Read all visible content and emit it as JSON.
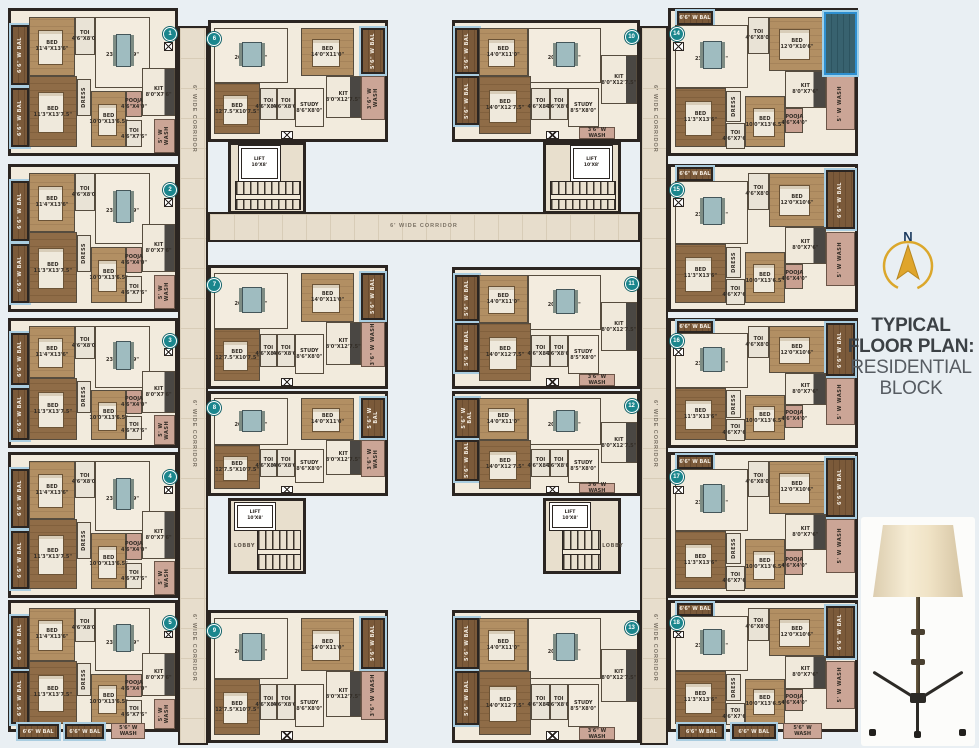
{
  "title": {
    "line1": "TYPICAL FLOOR PLAN:",
    "line2": "RESIDENTIAL BLOCK"
  },
  "compass": {
    "label": "N"
  },
  "colors": {
    "wall": "#2b2521",
    "corridor_tile": "#e7ddcc",
    "badge_teal": "#1b868d",
    "gold": "#dba72b",
    "navy": "#1c3a5e",
    "highlight_blue": "#2e8fd0",
    "title_dark": "#3c4145",
    "title_light": "#575c62",
    "background": "#e9eff3"
  },
  "plan": {
    "corridor_label": "6' WIDE CORRIDOR",
    "lift_label": {
      "name": "LIFT",
      "dims": "10'X8'"
    },
    "lobby_label": "LOBBY",
    "highlight": {
      "rect": {
        "x": 83,
        "y": 1,
        "w": 18,
        "h": 44
      }
    },
    "bottom_strips": [
      {
        "n": "6'6\" W BAL",
        "x": 4,
        "y": 96,
        "w": 25,
        "h": 12,
        "c": "bal"
      },
      {
        "n": "6'6\" W BAL",
        "x": 33,
        "y": 96,
        "w": 24,
        "h": 12,
        "c": "bal"
      },
      {
        "n": "5'6\" W WASH",
        "x": 61,
        "y": 95,
        "w": 21,
        "h": 13,
        "c": "wash"
      }
    ],
    "unit_types": {
      "corner-l": {
        "badge": {
          "x": 97,
          "y": 16
        },
        "rooms": [
          {
            "n": "6'6\" W BAL",
            "x": 0,
            "y": 10,
            "w": 11,
            "h": 42,
            "c": "bal",
            "v": 1
          },
          {
            "n": "6'6\" W BAL",
            "x": 0,
            "y": 54,
            "w": 11,
            "h": 42,
            "c": "bal",
            "v": 1
          },
          {
            "n": "BED",
            "d": "11'4\"X13'6\"",
            "x": 11,
            "y": 4,
            "w": 28,
            "h": 42,
            "c": "wood"
          },
          {
            "n": "TOI",
            "d": "4'6\"X8'0\"",
            "x": 39,
            "y": 4,
            "w": 12,
            "h": 27,
            "c": "tile"
          },
          {
            "n": "LIVDIN",
            "d": "23'3\"X10'9\"",
            "x": 51,
            "y": 4,
            "w": 34,
            "h": 50,
            "c": "cream",
            "furn": "dine"
          },
          {
            "n": "KIT",
            "d": "8'0\"X7'6\"",
            "x": 80,
            "y": 40,
            "w": 20,
            "h": 34,
            "c": "kit"
          },
          {
            "n": "BED",
            "d": "11'3\"X13'7.5\"",
            "x": 11,
            "y": 46,
            "w": 29,
            "h": 50,
            "c": "wood2"
          },
          {
            "n": "DRESS",
            "x": 40,
            "y": 48,
            "w": 9,
            "h": 26,
            "c": "tile",
            "v": 1
          },
          {
            "n": "BED",
            "d": "10'0\"X13'6.5\"",
            "x": 49,
            "y": 56,
            "w": 21,
            "h": 40,
            "c": "wood"
          },
          {
            "n": "POOJA",
            "d": "4'6\"X4'0\"",
            "x": 70,
            "y": 56,
            "w": 10,
            "h": 19,
            "c": "pink"
          },
          {
            "n": "TOI",
            "d": "4'6\"X7'6\"",
            "x": 70,
            "y": 77,
            "w": 10,
            "h": 19,
            "c": "tile"
          },
          {
            "n": "5' W WASH",
            "x": 87,
            "y": 76,
            "w": 13,
            "h": 24,
            "c": "wash",
            "v": 1
          },
          {
            "x": 93,
            "y": 22,
            "w": 6,
            "h": 6,
            "c": "door"
          }
        ]
      },
      "corner-r": {
        "badge": {
          "x": 3,
          "y": 16
        },
        "rooms": [
          {
            "n": "6'6\" W BAL",
            "x": 3,
            "y": 0,
            "w": 20,
            "h": 10,
            "c": "bal"
          },
          {
            "n": "LIVDIN",
            "d": "23'3\"X10'9\"",
            "x": 2,
            "y": 10,
            "w": 40,
            "h": 44,
            "c": "cream",
            "furn": "dine"
          },
          {
            "n": "TOI",
            "d": "4'6\"X8'0\"",
            "x": 42,
            "y": 4,
            "w": 11,
            "h": 26,
            "c": "tile"
          },
          {
            "n": "BED",
            "d": "12'0\"X10'6\"",
            "x": 53,
            "y": 4,
            "w": 31,
            "h": 38,
            "c": "wood"
          },
          {
            "n": "6'6\" W BAL",
            "x": 84,
            "y": 2,
            "w": 16,
            "h": 42,
            "c": "bal",
            "v": 1
          },
          {
            "n": "KIT",
            "d": "8'0\"X7'6\"",
            "x": 62,
            "y": 42,
            "w": 22,
            "h": 26,
            "c": "kit"
          },
          {
            "n": "5' W WASH",
            "x": 84,
            "y": 46,
            "w": 16,
            "h": 38,
            "c": "wash",
            "v": 1
          },
          {
            "n": "BED",
            "d": "11'3\"X13'6\"",
            "x": 2,
            "y": 54,
            "w": 28,
            "h": 42,
            "c": "wood2"
          },
          {
            "n": "DRESS",
            "x": 30,
            "y": 56,
            "w": 8,
            "h": 22,
            "c": "tile",
            "v": 1
          },
          {
            "n": "TOI",
            "d": "4'6\"X7'6\"",
            "x": 30,
            "y": 79,
            "w": 10,
            "h": 18,
            "c": "tile"
          },
          {
            "n": "BED",
            "d": "10'0\"X13'6.5\"",
            "x": 40,
            "y": 60,
            "w": 22,
            "h": 36,
            "c": "wood"
          },
          {
            "n": "POOJA",
            "d": "4'6\"X4'0\"",
            "x": 62,
            "y": 68,
            "w": 10,
            "h": 18,
            "c": "pink"
          },
          {
            "x": 1,
            "y": 22,
            "w": 6,
            "h": 6,
            "c": "door"
          }
        ]
      },
      "mid-l": {
        "badge": {
          "x": 2,
          "y": 14
        },
        "rooms": [
          {
            "n": "LIVDIN",
            "d": "20'5\"X10'9\"",
            "x": 2,
            "y": 4,
            "w": 42,
            "h": 48,
            "c": "cream",
            "furn": "dine"
          },
          {
            "n": "BED",
            "d": "14'0\"X11'0\"",
            "x": 52,
            "y": 4,
            "w": 30,
            "h": 42,
            "c": "wood"
          },
          {
            "n": "5'6\" W BAL",
            "x": 86,
            "y": 4,
            "w": 14,
            "h": 40,
            "c": "bal",
            "v": 1
          },
          {
            "n": "KIT",
            "d": "8'0\"X12'7.5\"",
            "x": 66,
            "y": 46,
            "w": 20,
            "h": 36,
            "c": "kit"
          },
          {
            "n": "3'6\" W WASH",
            "x": 86,
            "y": 46,
            "w": 14,
            "h": 38,
            "c": "wash",
            "v": 1
          },
          {
            "n": "BED",
            "d": "12'7.5\"X10'7.5\"",
            "x": 2,
            "y": 52,
            "w": 26,
            "h": 44,
            "c": "wood2"
          },
          {
            "n": "TOI",
            "d": "4'6\"X8'0\"",
            "x": 28,
            "y": 56,
            "w": 10,
            "h": 28,
            "c": "tile"
          },
          {
            "n": "TOI",
            "d": "4'6\"X8'0\"",
            "x": 38,
            "y": 56,
            "w": 10,
            "h": 28,
            "c": "tile"
          },
          {
            "n": "STUDY",
            "d": "8'6\"X8'0\"",
            "x": 48,
            "y": 56,
            "w": 17,
            "h": 34,
            "c": "cream"
          },
          {
            "x": 40,
            "y": 93,
            "w": 7,
            "h": 7,
            "c": "door"
          }
        ]
      },
      "mid-r": {
        "badge": {
          "x": 97,
          "y": 12
        },
        "rooms": [
          {
            "n": "5'6\" W BAL",
            "x": 0,
            "y": 4,
            "w": 13,
            "h": 40,
            "c": "bal",
            "v": 1
          },
          {
            "n": "5'6\" W BAL",
            "x": 0,
            "y": 46,
            "w": 13,
            "h": 42,
            "c": "bal",
            "v": 1
          },
          {
            "n": "BED",
            "d": "14'0\"X11'0\"",
            "x": 13,
            "y": 4,
            "w": 27,
            "h": 42,
            "c": "wood"
          },
          {
            "n": "LIVDIN",
            "d": "20'5\"X10'9\"",
            "x": 40,
            "y": 4,
            "w": 40,
            "h": 48,
            "c": "cream",
            "furn": "dine"
          },
          {
            "n": "KIT",
            "d": "8'0\"X12'7.5\"",
            "x": 80,
            "y": 28,
            "w": 20,
            "h": 42,
            "c": "kit"
          },
          {
            "n": "BED",
            "d": "14'0\"X12'7.5\"",
            "x": 13,
            "y": 46,
            "w": 29,
            "h": 50,
            "c": "wood2"
          },
          {
            "n": "TOI",
            "d": "4'6\"X8'0\"",
            "x": 42,
            "y": 56,
            "w": 10,
            "h": 28,
            "c": "tile"
          },
          {
            "n": "TOI",
            "d": "4'6\"X8'0\"",
            "x": 52,
            "y": 56,
            "w": 10,
            "h": 28,
            "c": "tile"
          },
          {
            "n": "STUDY",
            "d": "8'5\"X8'0\"",
            "x": 62,
            "y": 56,
            "w": 17,
            "h": 34,
            "c": "cream"
          },
          {
            "n": "3'6\" W WASH",
            "x": 68,
            "y": 90,
            "w": 20,
            "h": 10,
            "c": "wash"
          },
          {
            "x": 50,
            "y": 93,
            "w": 7,
            "h": 7,
            "c": "door"
          }
        ]
      }
    },
    "units": [
      {
        "badge": "1",
        "type": "corner-l",
        "x": 8,
        "y": 8,
        "w": 170,
        "h": 148
      },
      {
        "badge": "2",
        "type": "corner-l",
        "x": 8,
        "y": 164,
        "w": 170,
        "h": 148
      },
      {
        "badge": "3",
        "type": "corner-l",
        "x": 8,
        "y": 318,
        "w": 170,
        "h": 130
      },
      {
        "badge": "4",
        "type": "corner-l",
        "x": 8,
        "y": 452,
        "w": 170,
        "h": 146
      },
      {
        "badge": "5",
        "type": "corner-l",
        "x": 8,
        "y": 600,
        "w": 170,
        "h": 132,
        "bb": true
      },
      {
        "badge": "6",
        "type": "mid-l",
        "x": 208,
        "y": 20,
        "w": 180,
        "h": 122
      },
      {
        "badge": "7",
        "type": "mid-l",
        "x": 208,
        "y": 265,
        "w": 180,
        "h": 124
      },
      {
        "badge": "8",
        "type": "mid-l",
        "x": 208,
        "y": 391,
        "w": 180,
        "h": 105
      },
      {
        "badge": "9",
        "type": "mid-l",
        "x": 208,
        "y": 610,
        "w": 180,
        "h": 133
      },
      {
        "badge": "10",
        "type": "mid-r",
        "x": 452,
        "y": 20,
        "w": 188,
        "h": 122
      },
      {
        "badge": "11",
        "type": "mid-r",
        "x": 452,
        "y": 267,
        "w": 188,
        "h": 122
      },
      {
        "badge": "12",
        "type": "mid-r",
        "x": 452,
        "y": 391,
        "w": 188,
        "h": 105
      },
      {
        "badge": "13",
        "type": "mid-r",
        "x": 452,
        "y": 610,
        "w": 188,
        "h": 133
      },
      {
        "badge": "14",
        "type": "corner-r",
        "x": 668,
        "y": 8,
        "w": 190,
        "h": 148,
        "hl": true
      },
      {
        "badge": "15",
        "type": "corner-r",
        "x": 668,
        "y": 164,
        "w": 190,
        "h": 148
      },
      {
        "badge": "16",
        "type": "corner-r",
        "x": 668,
        "y": 318,
        "w": 190,
        "h": 130
      },
      {
        "badge": "17",
        "type": "corner-r",
        "x": 668,
        "y": 452,
        "w": 190,
        "h": 146
      },
      {
        "badge": "18",
        "type": "corner-r",
        "x": 668,
        "y": 600,
        "w": 190,
        "h": 132,
        "bb": true
      }
    ],
    "corridors": [
      {
        "vert": 1,
        "x": 178,
        "y": 26,
        "w": 30,
        "h": 719,
        "labels": [
          8,
          52,
          82
        ]
      },
      {
        "vert": 1,
        "x": 640,
        "y": 26,
        "w": 28,
        "h": 719,
        "labels": [
          8,
          52,
          82
        ]
      },
      {
        "vert": 0,
        "x": 208,
        "y": 212,
        "w": 432,
        "h": 30,
        "labels": [
          50
        ]
      }
    ],
    "cores": [
      {
        "x": 228,
        "y": 142,
        "w": 78,
        "h": 72,
        "lift": {
          "x": 14,
          "y": 4,
          "w": 48,
          "h": 44
        },
        "stairs": {
          "x": 5,
          "y": 54,
          "w": 90,
          "h": 42
        }
      },
      {
        "x": 543,
        "y": 142,
        "w": 78,
        "h": 72,
        "lift": {
          "x": 38,
          "y": 4,
          "w": 48,
          "h": 44
        },
        "stairs": {
          "x": 5,
          "y": 54,
          "w": 90,
          "h": 42
        }
      },
      {
        "x": 228,
        "y": 498,
        "w": 78,
        "h": 76,
        "lift": {
          "x": 8,
          "y": 5,
          "w": 48,
          "h": 30
        },
        "stairs": {
          "x": 36,
          "y": 42,
          "w": 58,
          "h": 54
        },
        "lobby": {
          "x": 4,
          "y": 62
        }
      },
      {
        "x": 543,
        "y": 498,
        "w": 78,
        "h": 76,
        "lift": {
          "x": 8,
          "y": 5,
          "w": 48,
          "h": 30
        },
        "stairs": {
          "x": 22,
          "y": 42,
          "w": 52,
          "h": 54
        },
        "lobby": {
          "x": 78,
          "y": 62
        }
      }
    ]
  }
}
